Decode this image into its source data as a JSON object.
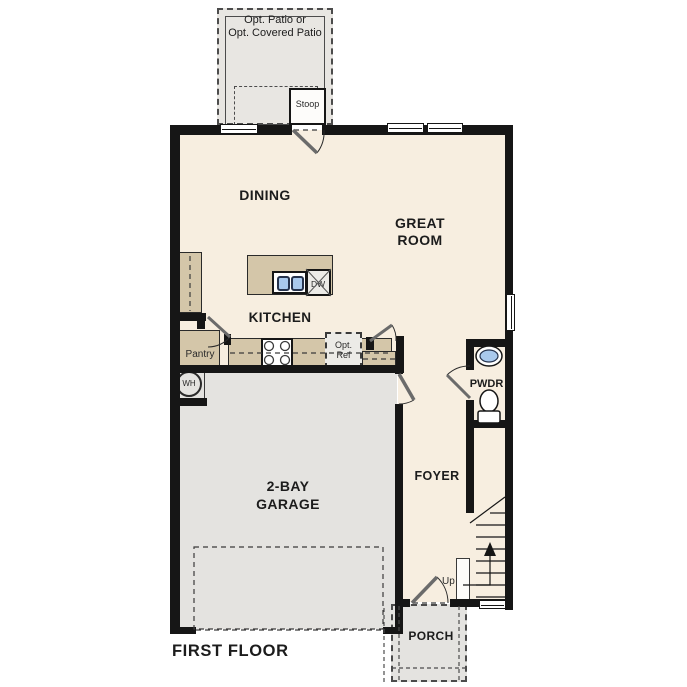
{
  "colors": {
    "wall": "#161616",
    "interior": "#f7eee0",
    "garage": "#e4e3e0",
    "outdoor": "#e8e6e2",
    "cabinet": "#d4c6a9",
    "appliance": "#ecebe7",
    "sink_blue": "#a9c9ed",
    "line": "#3a3a3a"
  },
  "floor_plan": {
    "title": "FIRST FLOOR",
    "rooms": {
      "dining": {
        "label": "DINING"
      },
      "great_room": {
        "line1": "GREAT",
        "line2": "ROOM"
      },
      "kitchen": {
        "label": "KITCHEN"
      },
      "pantry": {
        "label": "Pantry"
      },
      "powder_room": {
        "label": "PWDR"
      },
      "foyer": {
        "label": "FOYER"
      },
      "garage": {
        "line1": "2-BAY",
        "line2": "GARAGE"
      },
      "porch": {
        "label": "PORCH"
      },
      "stoop": {
        "label": "Stoop"
      },
      "patio": {
        "line1": "Opt. Patio or",
        "line2": "Opt. Covered Patio"
      }
    },
    "fixtures": {
      "dishwasher": {
        "label": "DW"
      },
      "water_heater": {
        "label": "WH"
      },
      "optional_refrigerator": {
        "line1": "Opt.",
        "line2": "Ref"
      },
      "stairs": {
        "direction": "Up"
      }
    }
  }
}
